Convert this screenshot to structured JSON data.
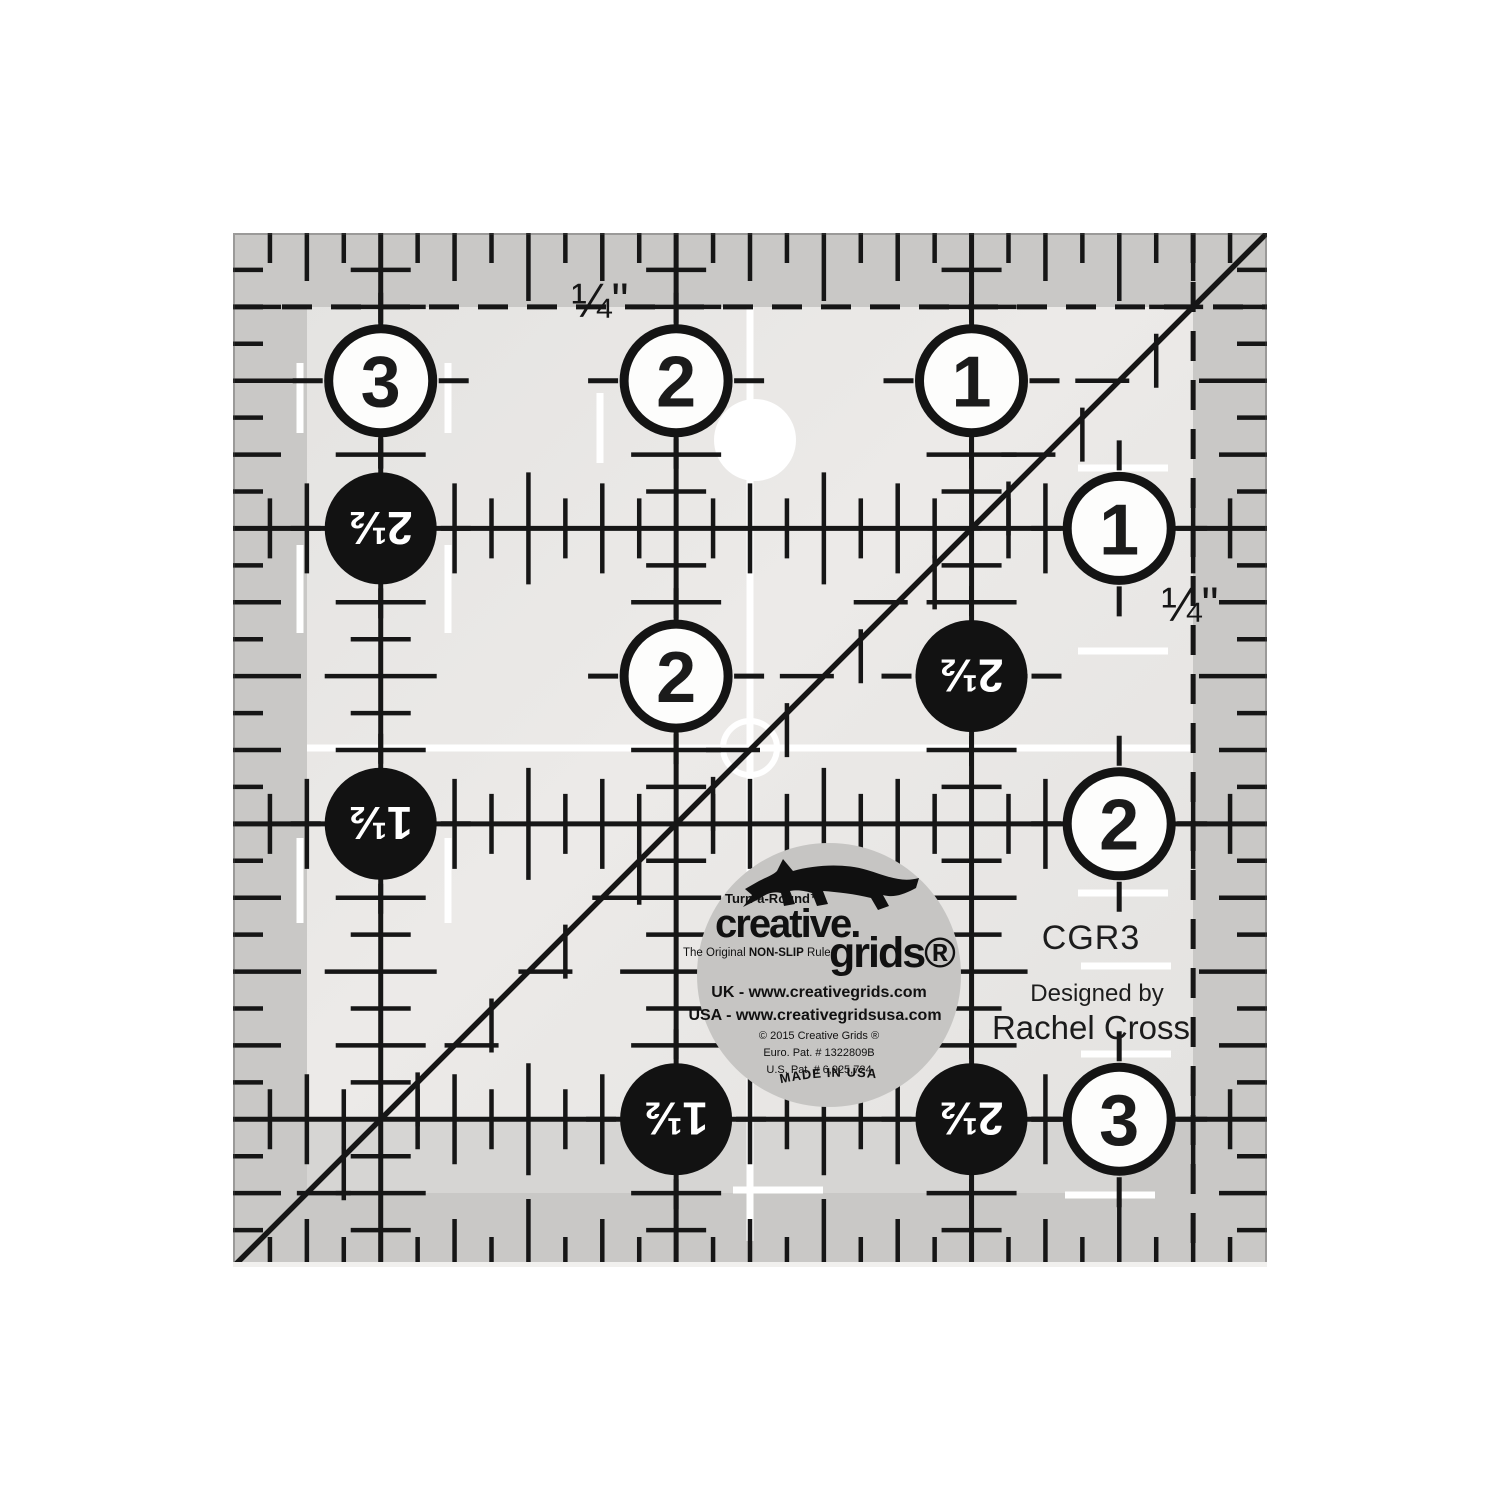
{
  "photo": {
    "background": "#ffffff"
  },
  "ruler": {
    "face_color": "#e9e8e6",
    "band_color": "#c9c8c6",
    "strip_color": "#d6d5d3",
    "corner_color": "#c9c8c6",
    "ink_color": "#161616",
    "white_mark_color": "#ffffff",
    "quarter_label_top": "¼\"",
    "quarter_label_right": "¼\"",
    "white_circles": [
      {
        "label": "3"
      },
      {
        "label": "2"
      },
      {
        "label": "1"
      },
      {
        "label": "1"
      },
      {
        "label": "2"
      },
      {
        "label": "2"
      },
      {
        "label": "3"
      }
    ],
    "black_circles": [
      {
        "label": "2½"
      },
      {
        "label": "1½"
      },
      {
        "label": "2½"
      },
      {
        "label": "1½"
      },
      {
        "label": "2½"
      }
    ]
  },
  "logo": {
    "turnaround": "Turn-a-Round™",
    "brand_top": "creative.",
    "brand_bottom": "grids®",
    "tagline_pre": "The Original ",
    "tagline_bold": "NON-SLIP",
    "tagline_post": " Ruler",
    "url_uk": "UK - www.creativegrids.com",
    "url_usa": "USA - www.creativegridsusa.com",
    "copyright": "© 2015  Creative Grids ®",
    "patent_euro": "Euro. Pat. # 1322809B",
    "patent_us": "U.S. Pat. # 6,925,724",
    "made_in": "MADE IN USA"
  },
  "product": {
    "code": "CGR3",
    "designed_by": "Designed by",
    "designer": "Rachel Cross"
  }
}
